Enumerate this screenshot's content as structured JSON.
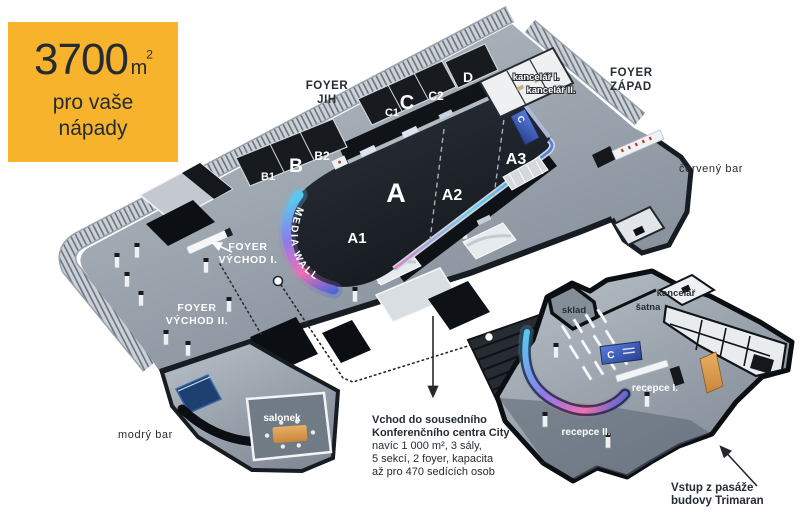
{
  "badge": {
    "value": "3700",
    "unit": "m",
    "unit_exponent": "2",
    "subtitle_line1": "pro vaše",
    "subtitle_line2": "nápady"
  },
  "plan": {
    "halls": {
      "a": "A",
      "a1": "A1",
      "a2": "A2",
      "a3": "A3",
      "b": "B",
      "b1": "B1",
      "b2": "B2",
      "c": "C",
      "c1": "C1",
      "c2": "C2",
      "d": "D"
    },
    "media_wall": "MEDIA WALL",
    "wall_logo": "C",
    "rooms": {
      "kancelar_1": "kancelář I.",
      "kancelar_2": "kancelář II.",
      "salonek": "salonek",
      "sklad": "sklad",
      "satna": "šatna",
      "kancelar": "kancelář",
      "recepce_1": "recepce I.",
      "recepce_2": "recepce II."
    },
    "foyers": {
      "jih_line1": "FOYER",
      "jih_line2": "JIH",
      "zapad_line1": "FOYER",
      "zapad_line2": "ZÁPAD",
      "vychod1_line1": "FOYER",
      "vychod1_line2": "VÝCHOD I.",
      "vychod2_line1": "FOYER",
      "vychod2_line2": "VÝCHOD II."
    },
    "bars": {
      "cerveny": "červený bar",
      "modry": "modrý bar"
    }
  },
  "annotations": {
    "vchod_line1": "Vchod do sousedního",
    "vchod_line2": "Konferenčního centra City",
    "vchod_line3": "navíc 1 000 m², 3 sály,",
    "vchod_line4": "5 sekcí, 2 foyer, kapacita",
    "vchod_line5": "až pro 470 sedících osob",
    "vstup_line1": "Vstup z pasáže",
    "vstup_line2": "budovy Trimaran"
  },
  "colors": {
    "badge_bg": "#f6b32b",
    "badge_text": "#252b33",
    "floor_light": "#b6bdc5",
    "floor_dark": "#848e99",
    "hall_dark": "#171b21",
    "label_dark": "#262c33",
    "led_cyan": "#59c9f0",
    "led_violet": "#8b7bea",
    "led_pink": "#ef6fb3",
    "led_blue": "#4a67d8",
    "accent_red": "#c0392b",
    "accent_orange": "#d9913f",
    "accent_navy": "#1e4070"
  }
}
